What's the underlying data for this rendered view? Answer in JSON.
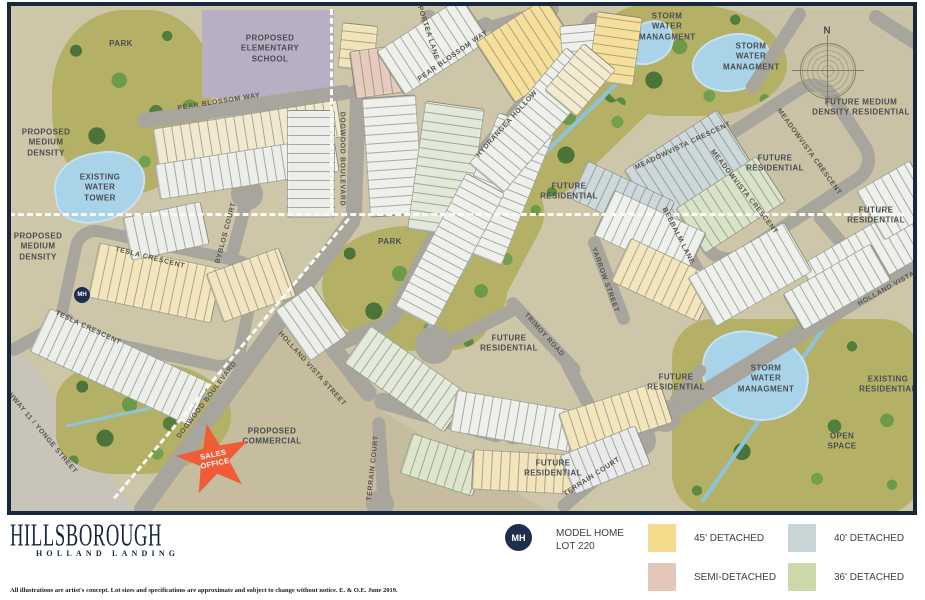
{
  "map": {
    "streets": [
      {
        "text": "PEAR BLOSSOM WAY"
      },
      {
        "text": "PEAR BLOSSOM WAY"
      },
      {
        "text": "PORTEA LANE"
      },
      {
        "text": "DOGWOOD BOULEVARD"
      },
      {
        "text": "DOGWOOD BOULEVARD"
      },
      {
        "text": "HYDRANGEA HOLLOW"
      },
      {
        "text": "MEADOWVISTA CRESCENT"
      },
      {
        "text": "MEADOWVISTA CRESCENT"
      },
      {
        "text": "MEADOWVISTA CRESCENT"
      },
      {
        "text": "BYBLOS COURT"
      },
      {
        "text": "TESLA CRESCENT"
      },
      {
        "text": "TESLA CRESCENT"
      },
      {
        "text": "HOLLAND VISTA STREET"
      },
      {
        "text": "HOLLAND VISTA ST"
      },
      {
        "text": "YARROW STREET"
      },
      {
        "text": "BEEBALM LANE"
      },
      {
        "text": "TRIMOY ROAD"
      },
      {
        "text": "TERRAIN COURT"
      },
      {
        "text": "TERRAIN COURT"
      },
      {
        "text": "HIGHWAY 11 / YONGE STREET"
      }
    ],
    "regions": [
      {
        "text": "PARK"
      },
      {
        "text": "PROPOSED ELEMENTARY SCHOOL"
      },
      {
        "text": "PROPOSED MEDIUM DENSITY"
      },
      {
        "text": "EXISTING WATER TOWER"
      },
      {
        "text": "PROPOSED MEDIUM DENSITY"
      },
      {
        "text": "STORM WATER MANAGMENT"
      },
      {
        "text": "STORM WATER MANAGMENT"
      },
      {
        "text": "FUTURE MEDIUM DENSITY RESIDENTIAL"
      },
      {
        "text": "FUTURE RESIDENTIAL"
      },
      {
        "text": "FUTURE RESIDENTIAL"
      },
      {
        "text": "FUTURE RESIDENTIAL"
      },
      {
        "text": "PARK"
      },
      {
        "text": "FUTURE RESIDENTIAL"
      },
      {
        "text": "FUTURE RESIDENTIAL"
      },
      {
        "text": "FUTURE RESIDENTIAL"
      },
      {
        "text": "STORM WATER MANAGMENT"
      },
      {
        "text": "EXISTING RESIDENTIAL"
      },
      {
        "text": "OPEN SPACE"
      },
      {
        "text": "PROPOSED COMMERCIAL"
      }
    ],
    "compass": {
      "north": "N"
    },
    "sales_office": {
      "label": "SALES OFFICE"
    },
    "model_home_marker": "MH"
  },
  "legend": {
    "marker": {
      "abbr": "MH",
      "line1": "MODEL HOME",
      "line2": "LOT 220"
    },
    "items": [
      {
        "label": "45' DETACHED",
        "color": "#f5dc8c"
      },
      {
        "label": "40' DETACHED",
        "color": "#c8d5d7"
      },
      {
        "label": "SEMI-DETACHED",
        "color": "#e3c7b8"
      },
      {
        "label": "36' DETACHED",
        "color": "#cbd9a9"
      }
    ]
  },
  "logo": {
    "title": "HILLSBOROUGH",
    "subtitle": "HOLLAND LANDING"
  },
  "disclaimer": "All illustrations are artist's concept. Lot sizes and specifications are approximate and subject to change without notice. E. & O.E. June 2019.",
  "colors": {
    "map_border": "#16283e",
    "road": "#a8a59d",
    "water": "#a9d3e8",
    "park_green": "#b4b166",
    "school": "#b8afc5",
    "sales_star": "#f15b38",
    "logo_navy": "#16283e"
  }
}
